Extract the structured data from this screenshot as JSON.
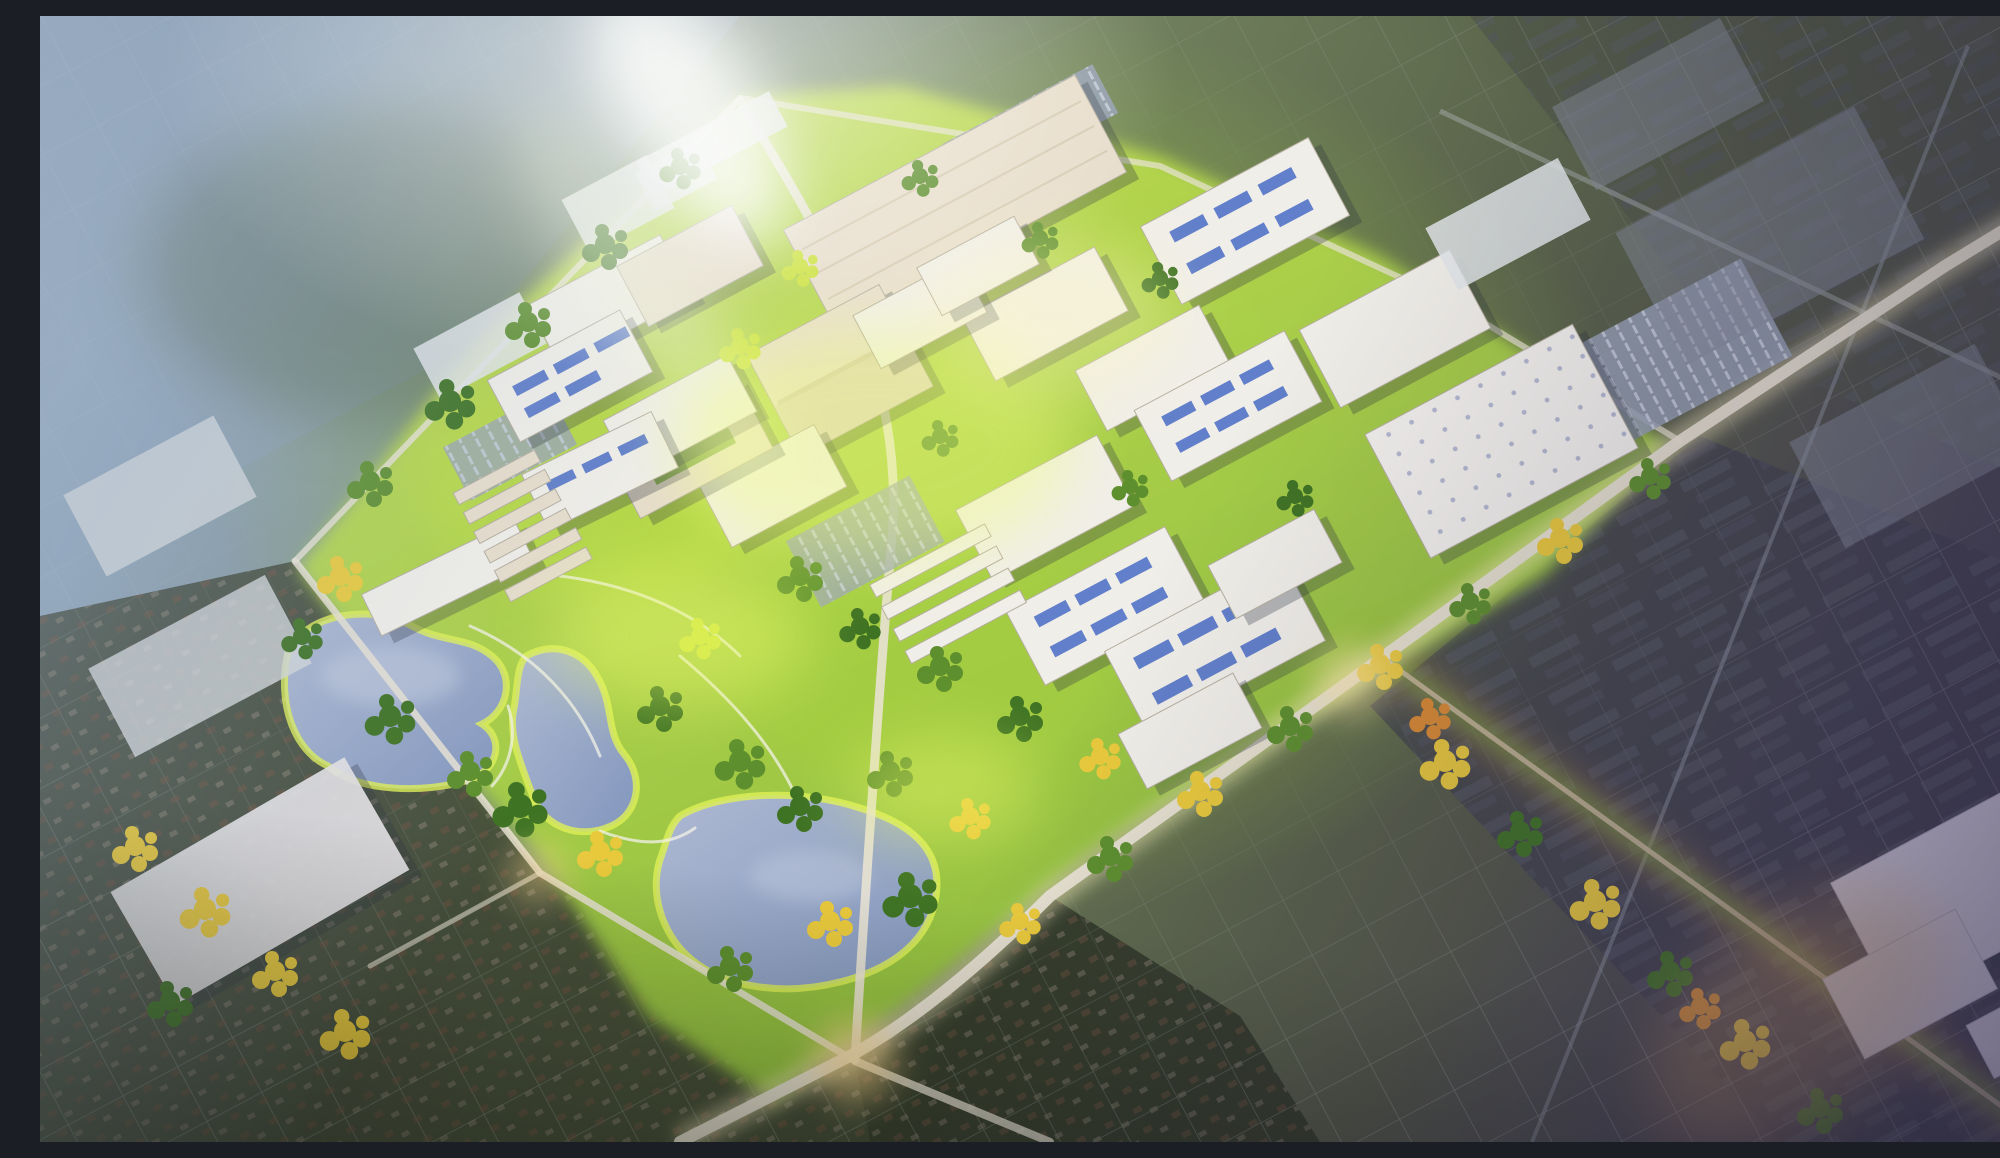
{
  "scene": {
    "type": "aerial-architectural-rendering",
    "alt": "Sunlit aerial rendering of a master-planned mixed-use campus: white office buildings, parking garages with blue rooftop panels, large distribution warehouses, three lakes with bright parkland and trails, tree-lined boulevards glowing in sunlight, surrounded by muted existing city fabric — residential blocks, big-box stores, dark industrial roofs and a shopping mall.",
    "elements": {
      "lakes": [
        "west lake",
        "middle lake",
        "south lake"
      ],
      "districts": [
        "campus core",
        "north warehouse row",
        "east warehouse",
        "lakeside park",
        "townhome rows",
        "existing residential southwest",
        "industrial east",
        "shopping mall southeast"
      ],
      "roads": [
        "main boulevard",
        "campus spine road",
        "northwest boundary road",
        "southwest boundary road",
        "north edge road",
        "southeast greenway",
        "railroad line",
        "existing arterial road"
      ]
    }
  },
  "palette": {
    "haze-blue": "#9fb2c8",
    "city-gray": "#8795a6",
    "campus-green": "#8dbd3e",
    "campus-bright": "#c8e352",
    "sun-glow": "#fdf9c9",
    "tree-green": "#5d8f2e",
    "tree-dark": "#3f7324",
    "tree-lime": "#cbe23b",
    "tree-gold": "#e9c93c",
    "tree-orange": "#d98a33",
    "lake-blue": "#aeb9d2",
    "lake-deep": "#8296bd",
    "shore-glow": "#dff056",
    "roof-white": "#f0eee8",
    "roof-cream": "#e7ddcb",
    "roof-shadow": "#2b3140",
    "solar-blue": "#3d63c2",
    "road-light": "#e8e2d4",
    "road-warm": "#e7b56a",
    "industrial-dark": "#4c4a5e",
    "residential-dark": "#39402e",
    "mall-white": "#dcd7e8"
  }
}
